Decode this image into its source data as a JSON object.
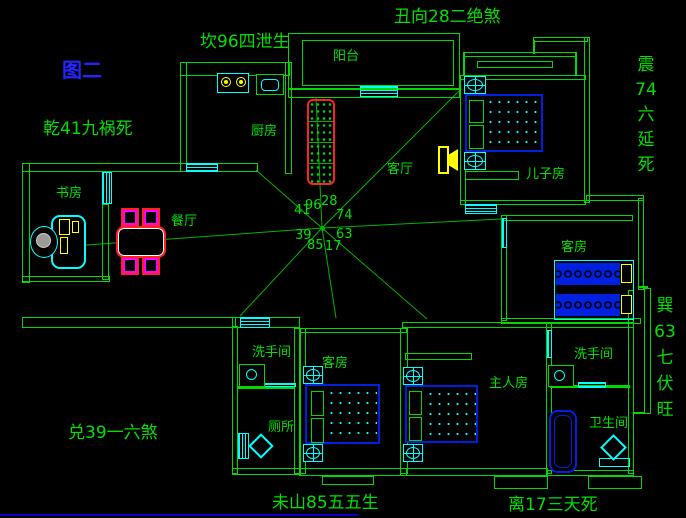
{
  "colors": {
    "wall": "#00d800",
    "line": "#00b400",
    "win": "#00ffff",
    "bed": "#0020e0",
    "accent": "#ffff00",
    "red": "#ff2020",
    "magenta": "#ff00ff",
    "text": "#00e000",
    "blue": "#2424ff",
    "bar": "#0000c8"
  },
  "figure_label": "图二",
  "annotations": {
    "chou": "丑向28二绝煞",
    "kan": "坎96四泄生",
    "qian": "乾41九祸死",
    "dui": "兑39一六煞",
    "wei": "未山85五五生",
    "li": "离17三天死",
    "zhen": [
      "震",
      "74",
      "六",
      "延",
      "死"
    ],
    "xun": [
      "巽",
      "63",
      "七",
      "伏",
      "旺"
    ]
  },
  "rooms": {
    "balcony": "阳台",
    "kitchen": "厨房",
    "living": "客厅",
    "son": "儿子房",
    "study": "书房",
    "dining": "餐厅",
    "guest_right": "客房",
    "washroom_left": "洗手间",
    "guest_bottom": "客房",
    "master": "主人房",
    "washroom_right": "洗手间",
    "toilet": "厕所",
    "bathroom": "卫生间"
  },
  "compass": {
    "w": "41",
    "nw": "96",
    "n": "28",
    "ne": "74",
    "e": "63",
    "se": "17",
    "s": "85",
    "sw": "39"
  }
}
